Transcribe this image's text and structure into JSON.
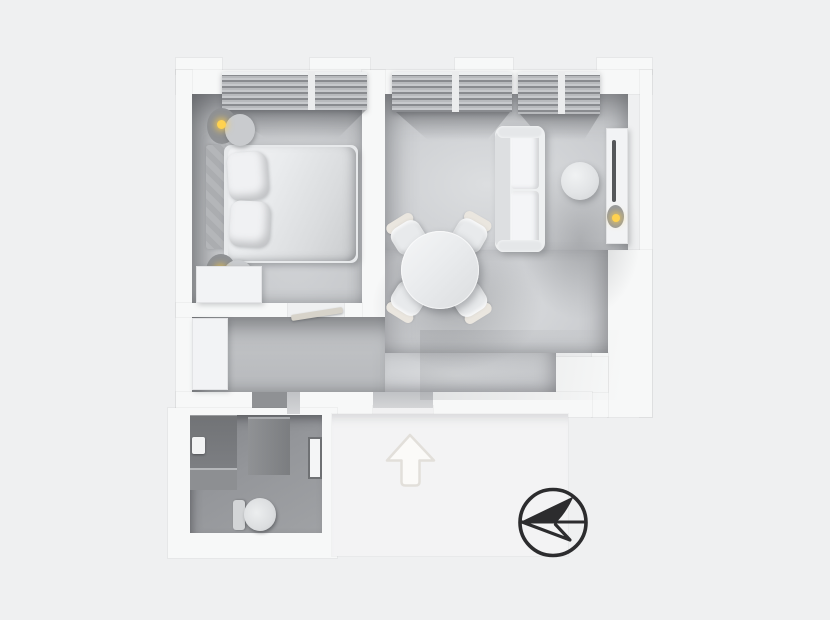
{
  "page": {
    "title_visible_text": ""
  },
  "colors": {
    "page_background": "#eff0f1",
    "wall": "#f7f8f8",
    "landing": "#f3f3f4",
    "lamp_glow": "#ffd24f",
    "tv": "#55575a",
    "compass": "#2c2c2e",
    "entrance_arrow_fill": "#fbfaf8",
    "entrance_arrow_edge": "#e2dfda"
  },
  "floorplan": {
    "type": "3d-top-down-apartment-render",
    "rooms": [
      {
        "id": "bedroom",
        "furniture": [
          "double-bed",
          "headboard",
          "pillow",
          "pillow",
          "nightstand-lamp",
          "nightstand-lamp",
          "dresser",
          "window-blinds"
        ]
      },
      {
        "id": "living-dining-room",
        "furniture": [
          "sofa",
          "side-table",
          "tv-console",
          "tv",
          "console-lamp",
          "round-dining-table",
          "dining-chair",
          "dining-chair",
          "dining-chair",
          "dining-chair",
          "window-blinds",
          "window-blinds"
        ]
      },
      {
        "id": "hallway",
        "furniture": [
          "wardrobe",
          "open-door-leaf"
        ]
      },
      {
        "id": "bathroom",
        "furniture": [
          "shower",
          "sink-counter",
          "faucet",
          "toilet",
          "door-panel"
        ]
      }
    ],
    "markers": [
      {
        "id": "entrance-arrow",
        "meaning": "entrance, arrow pointing up"
      },
      {
        "id": "compass",
        "meaning": "orientation compass, arrow pointing left"
      }
    ]
  }
}
